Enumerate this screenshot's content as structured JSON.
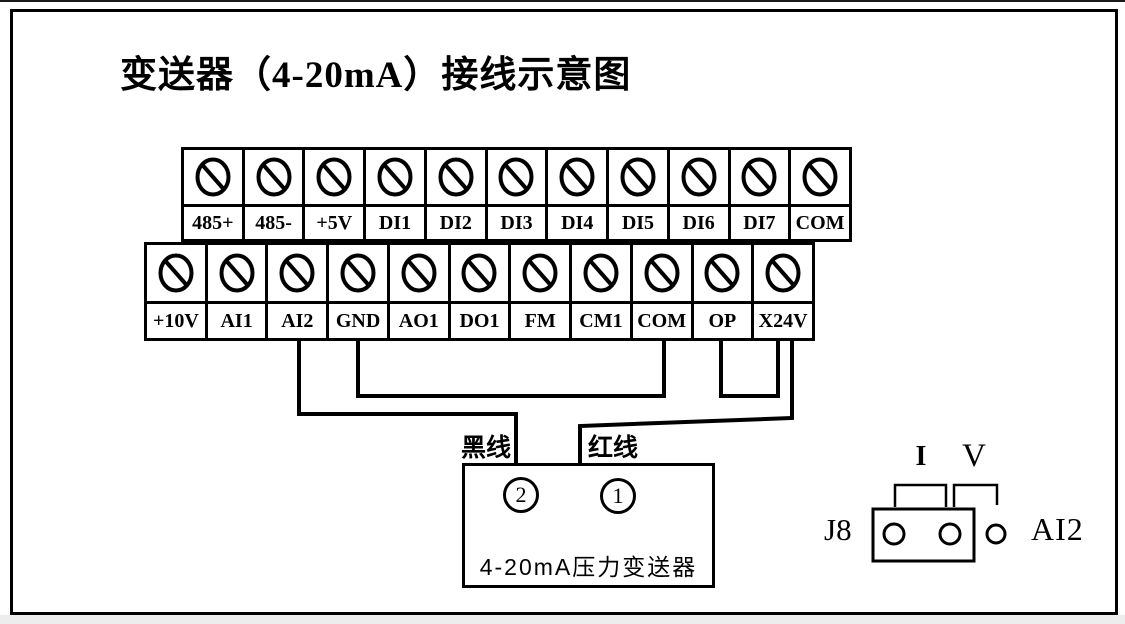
{
  "title": "变送器（4-20mA）接线示意图",
  "terminal_strips": {
    "top": {
      "labels": [
        "485+",
        "485-",
        "+5V",
        "DI1",
        "DI2",
        "DI3",
        "DI4",
        "DI5",
        "DI6",
        "DI7",
        "COM"
      ]
    },
    "bottom": {
      "labels": [
        "+10V",
        "AI1",
        "AI2",
        "GND",
        "AO1",
        "DO1",
        "FM",
        "CM1",
        "COM",
        "OP",
        "X24V"
      ]
    }
  },
  "wires": {
    "black_label": "黑线",
    "red_label": "红线",
    "connections": [
      {
        "from": "AI2",
        "to": "transmitter terminal 2",
        "wire": "黑线 (black wire)"
      },
      {
        "from": "X24V",
        "to": "transmitter terminal 1",
        "wire": "红线 (red wire)"
      },
      {
        "from": "GND",
        "to": "COM",
        "wire": "jumper"
      },
      {
        "from": "OP",
        "to": "X24V",
        "wire": "jumper"
      }
    ]
  },
  "transmitter": {
    "name": "4-20mA压力变送器",
    "terminal_left": "2",
    "terminal_right": "1"
  },
  "jumper_block": {
    "connector_label": "J8",
    "channel_label": "AI2",
    "mode_current": "I",
    "mode_voltage": "V",
    "jumper_position": "I (pins 1-2 capped)"
  },
  "colors": {
    "ink": "#000000",
    "background": "#ffffff"
  }
}
